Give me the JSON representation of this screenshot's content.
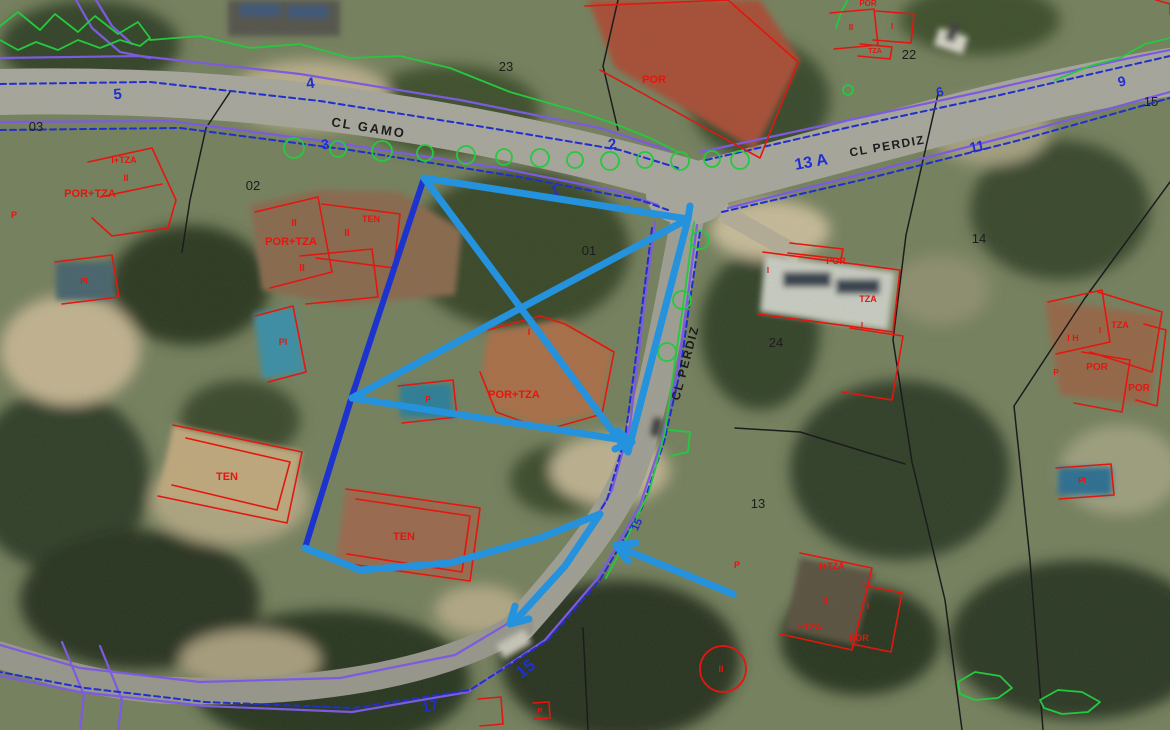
{
  "map": {
    "colors": {
      "building_red": "#E3170F",
      "boundary_purple": "#7D5BE0",
      "frontage_blue": "#1F2FD0",
      "house_number_blue": "#1F2FD0",
      "parcel_black": "#1C1C1C",
      "vegetation_green": "#25C93F",
      "annotation_main": "#2492DC",
      "annotation_dark": "#1C33CF"
    },
    "streets": [
      {
        "name": "CL GAMO",
        "x": 368,
        "y": 132,
        "rotate": 9,
        "size": 13,
        "spacing": 2
      },
      {
        "name": "CL PERDIZ",
        "x": 888,
        "y": 150,
        "rotate": -10,
        "size": 12,
        "spacing": 1.5
      },
      {
        "name": "CL PERDIZ",
        "x": 689,
        "y": 364,
        "rotate": -75,
        "size": 12,
        "spacing": 1.5
      }
    ],
    "house_numbers": [
      {
        "text": "5",
        "x": 118,
        "y": 99,
        "rotate": -5,
        "size": 15
      },
      {
        "text": "4",
        "x": 311,
        "y": 88,
        "rotate": -8,
        "size": 15
      },
      {
        "text": "3",
        "x": 326,
        "y": 149,
        "rotate": -10,
        "size": 14
      },
      {
        "text": "2",
        "x": 613,
        "y": 149,
        "rotate": -8,
        "size": 15
      },
      {
        "text": "1",
        "x": 556,
        "y": 195,
        "rotate": -15,
        "size": 14
      },
      {
        "text": "13 A",
        "x": 812,
        "y": 167,
        "rotate": -10,
        "size": 16
      },
      {
        "text": "11",
        "x": 978,
        "y": 151,
        "rotate": -12,
        "size": 14
      },
      {
        "text": "6",
        "x": 941,
        "y": 96,
        "rotate": -15,
        "size": 13
      },
      {
        "text": "9",
        "x": 1123,
        "y": 86,
        "rotate": -15,
        "size": 14
      },
      {
        "text": "15",
        "x": 640,
        "y": 526,
        "rotate": -65,
        "size": 11
      },
      {
        "text": "15",
        "x": 529,
        "y": 673,
        "rotate": -38,
        "size": 17
      },
      {
        "text": "17",
        "x": 431,
        "y": 711,
        "rotate": -12,
        "size": 15
      }
    ],
    "parcel_numbers": [
      {
        "text": "03",
        "x": 36,
        "y": 131
      },
      {
        "text": "02",
        "x": 253,
        "y": 190
      },
      {
        "text": "23",
        "x": 506,
        "y": 71
      },
      {
        "text": "01",
        "x": 589,
        "y": 255
      },
      {
        "text": "22",
        "x": 909,
        "y": 59
      },
      {
        "text": "15",
        "x": 1151,
        "y": 106
      },
      {
        "text": "14",
        "x": 979,
        "y": 243
      },
      {
        "text": "24",
        "x": 776,
        "y": 347
      },
      {
        "text": "13",
        "x": 758,
        "y": 508
      }
    ],
    "buildings": {
      "outlines": [
        {
          "points": "88,162 152,148 176,200 168,228 112,236 92,218"
        },
        {
          "points": "100,197 162,184"
        },
        {
          "points": "55,262 112,255 119,297 62,304"
        },
        {
          "points": "255,212 318,197 332,272 270,288"
        },
        {
          "points": "322,204 400,214 394,268 316,258"
        },
        {
          "points": "300,256 372,249 378,297 306,304"
        },
        {
          "points": "255,316 293,306 306,372 268,382"
        },
        {
          "points": "488,330 540,316 565,324 614,352 602,414 546,430 496,412 480,372"
        },
        {
          "points": "398,386 453,380 457,417 402,423"
        },
        {
          "points": "173,425 302,452 287,523 158,496"
        },
        {
          "points": "186,438 290,462 277,510 172,485"
        },
        {
          "points": "346,489 480,508 470,581 336,562"
        },
        {
          "points": "356,499 470,516 462,572 347,554"
        },
        {
          "points": "763,252 900,270 893,332 758,314"
        },
        {
          "points": "850,328 903,336 892,400 842,392"
        },
        {
          "points": "790,243 843,249 841,259 788,253"
        },
        {
          "points": "1048,302 1102,290 1110,342 1056,354"
        },
        {
          "points": "1098,292 1162,312 1152,372 1090,352"
        },
        {
          "points": "1082,352 1130,360 1122,412 1074,403"
        },
        {
          "points": "1144,324 1166,330 1157,406 1136,400"
        },
        {
          "points": "800,553 872,568 852,650 780,634"
        },
        {
          "points": "862,585 902,593 891,652 852,644"
        },
        {
          "points": "1056,468 1111,464 1114,495 1059,499"
        },
        {
          "points": "585,6 728,0 798,62 760,158 600,70"
        },
        {
          "points": "830,13 874,9 878,45 834,49"
        },
        {
          "points": "876,11 914,14 911,43 873,40"
        },
        {
          "points": "860,44 892,47 890,59 858,56"
        },
        {
          "points": "1156,0 1170,4 1170,14"
        },
        {
          "points": "478,699 501,697 503,724 480,726"
        },
        {
          "points": "533,703 549,702 550,718 534,719"
        }
      ],
      "circles": [
        {
          "cx": 723,
          "cy": 669,
          "r": 23
        }
      ],
      "labels": [
        {
          "text": "I+TZA",
          "x": 124,
          "y": 163,
          "size": 9
        },
        {
          "text": "II",
          "x": 126,
          "y": 181,
          "size": 9
        },
        {
          "text": "POR+TZA",
          "x": 90,
          "y": 197,
          "size": 11
        },
        {
          "text": "PI",
          "x": 84,
          "y": 284,
          "size": 8
        },
        {
          "text": "P",
          "x": 14,
          "y": 218,
          "size": 9
        },
        {
          "text": "II",
          "x": 294,
          "y": 226,
          "size": 10
        },
        {
          "text": "TEN",
          "x": 371,
          "y": 222,
          "size": 9
        },
        {
          "text": "POR+TZA",
          "x": 291,
          "y": 245,
          "size": 11
        },
        {
          "text": "II",
          "x": 302,
          "y": 271,
          "size": 10
        },
        {
          "text": "II",
          "x": 347,
          "y": 236,
          "size": 10
        },
        {
          "text": "PI",
          "x": 283,
          "y": 345,
          "size": 9
        },
        {
          "text": "I",
          "x": 529,
          "y": 335,
          "size": 9
        },
        {
          "text": "POR+TZA",
          "x": 514,
          "y": 398,
          "size": 11
        },
        {
          "text": "P",
          "x": 428,
          "y": 402,
          "size": 8
        },
        {
          "text": "TEN",
          "x": 227,
          "y": 480,
          "size": 11
        },
        {
          "text": "TEN",
          "x": 404,
          "y": 540,
          "size": 11
        },
        {
          "text": "POR",
          "x": 836,
          "y": 264,
          "size": 9
        },
        {
          "text": "I",
          "x": 768,
          "y": 273,
          "size": 8
        },
        {
          "text": "TZA",
          "x": 868,
          "y": 302,
          "size": 9
        },
        {
          "text": "I",
          "x": 862,
          "y": 328,
          "size": 8
        },
        {
          "text": "TZA",
          "x": 1120,
          "y": 328,
          "size": 9
        },
        {
          "text": "I H",
          "x": 1073,
          "y": 341,
          "size": 9
        },
        {
          "text": "I",
          "x": 1100,
          "y": 333,
          "size": 8
        },
        {
          "text": "POR",
          "x": 1097,
          "y": 370,
          "size": 10
        },
        {
          "text": "POR",
          "x": 1139,
          "y": 391,
          "size": 10
        },
        {
          "text": "P",
          "x": 1056,
          "y": 375,
          "size": 8
        },
        {
          "text": "I+TZA",
          "x": 832,
          "y": 569,
          "size": 9
        },
        {
          "text": "II",
          "x": 825,
          "y": 604,
          "size": 10
        },
        {
          "text": "I+TZA",
          "x": 809,
          "y": 630,
          "size": 9
        },
        {
          "text": "POR",
          "x": 859,
          "y": 641,
          "size": 9
        },
        {
          "text": "I",
          "x": 868,
          "y": 609,
          "size": 8
        },
        {
          "text": "P",
          "x": 737,
          "y": 568,
          "size": 9
        },
        {
          "text": "II",
          "x": 721,
          "y": 672,
          "size": 9
        },
        {
          "text": "PI",
          "x": 1082,
          "y": 483,
          "size": 8
        },
        {
          "text": "POR",
          "x": 654,
          "y": 83,
          "size": 11
        },
        {
          "text": "II",
          "x": 851,
          "y": 30,
          "size": 8
        },
        {
          "text": "I",
          "x": 892,
          "y": 29,
          "size": 8
        },
        {
          "text": "TZA",
          "x": 875,
          "y": 53,
          "size": 7
        },
        {
          "text": "POR",
          "x": 868,
          "y": 6,
          "size": 8
        },
        {
          "text": "P",
          "x": 540,
          "y": 713,
          "size": 7
        }
      ]
    },
    "boundaries": {
      "purple": [
        {
          "points": "0,58 140,56 300,74 460,100 600,128 668,150"
        },
        {
          "points": "0,122 170,121 330,142 500,168 620,192 658,205"
        },
        {
          "points": "700,152 840,122 980,92 1120,60 1170,50"
        },
        {
          "points": "728,208 870,172 1010,136 1170,92"
        },
        {
          "points": "655,222 646,290 638,360 630,425 612,490 575,555 522,615 455,655 340,678 200,682 80,668 0,645"
        },
        {
          "points": "697,225 688,295 678,368 662,440 640,505 598,578 545,640 468,692 352,712 205,706 80,692 0,676"
        },
        {
          "points": "62,642 84,695 80,730"
        },
        {
          "points": "100,646 122,700 118,730"
        },
        {
          "points": "76,0 92,28 120,52 150,58"
        },
        {
          "points": "96,0 112,26 132,44"
        }
      ],
      "blue_dashed": [
        {
          "points": "0,84 150,82 320,101 490,128 620,150 678,168"
        },
        {
          "points": "0,130 180,128 350,150 520,177 640,200 668,210"
        },
        {
          "points": "706,160 850,127 1000,95 1170,56"
        },
        {
          "points": "722,212 870,178 1020,140 1170,98"
        },
        {
          "points": "652,228 643,300 634,372 625,438 607,500 567,562 516,618"
        },
        {
          "points": "700,232 690,300 680,372 664,442 642,508 600,580 548,640 470,690 355,708 205,702 85,688 0,672"
        }
      ],
      "black": [
        {
          "points": "230,92 206,128 190,200 182,252"
        },
        {
          "points": "618,0 603,66 618,130"
        },
        {
          "points": "938,94 906,235 893,340 912,462 945,600 962,730"
        },
        {
          "points": "1170,182 1085,298 1014,406 1030,560 1043,730"
        },
        {
          "points": "583,628 588,730"
        },
        {
          "points": "735,428 800,432 905,464"
        }
      ]
    },
    "vegetation": {
      "lines": [
        {
          "points": "0,26 18,12 40,30 55,14 78,32 95,16 118,34 138,22 150,38 140,46 120,40 100,48 78,40 58,50 36,42 18,50 0,40"
        },
        {
          "points": "150,40 200,36 250,48 300,44 350,58 400,56 450,68 480,80 510,92 545,102 580,112 615,124 650,138 678,152"
        },
        {
          "points": "1055,80 1090,66 1120,58 1145,44 1170,38"
        },
        {
          "points": "836,28 842,10 848,0"
        },
        {
          "points": "668,430 690,432 688,452 670,456"
        },
        {
          "points": "694,222 685,292 675,362 665,432 649,492 620,552 606,578"
        },
        {
          "points": "958,682 975,672 1000,676 1012,688 998,698 975,700 960,694 958,682"
        },
        {
          "points": "1040,700 1058,690 1082,692 1100,702 1088,712 1062,714 1044,708 1040,700"
        }
      ],
      "trees": [
        {
          "cx": 294,
          "cy": 148,
          "r": 10
        },
        {
          "cx": 338,
          "cy": 149,
          "r": 8
        },
        {
          "cx": 382,
          "cy": 151,
          "r": 10
        },
        {
          "cx": 425,
          "cy": 153,
          "r": 8
        },
        {
          "cx": 466,
          "cy": 155,
          "r": 9
        },
        {
          "cx": 504,
          "cy": 157,
          "r": 8
        },
        {
          "cx": 540,
          "cy": 158,
          "r": 9
        },
        {
          "cx": 575,
          "cy": 160,
          "r": 8
        },
        {
          "cx": 610,
          "cy": 161,
          "r": 9
        },
        {
          "cx": 645,
          "cy": 160,
          "r": 8
        },
        {
          "cx": 680,
          "cy": 161,
          "r": 9
        },
        {
          "cx": 712,
          "cy": 159,
          "r": 8
        },
        {
          "cx": 740,
          "cy": 160,
          "r": 9
        },
        {
          "cx": 700,
          "cy": 240,
          "r": 9
        },
        {
          "cx": 682,
          "cy": 300,
          "r": 9
        },
        {
          "cx": 667,
          "cy": 352,
          "r": 9
        },
        {
          "cx": 848,
          "cy": 90,
          "r": 5
        }
      ]
    },
    "annotation": {
      "lines": [
        {
          "points": "424,178 352,396 305,548",
          "c": "dark",
          "w": 6
        },
        {
          "points": "424,178 688,219",
          "c": "main",
          "w": 7
        },
        {
          "points": "690,206 688,219 628,452",
          "c": "main",
          "w": 7
        },
        {
          "points": "424,178 628,452",
          "c": "main",
          "w": 7
        },
        {
          "points": "688,219 352,398",
          "c": "main",
          "w": 7
        },
        {
          "points": "352,398 630,441",
          "c": "main",
          "w": 7
        },
        {
          "points": "615,449 632,442 618,431",
          "c": "main",
          "w": 7
        },
        {
          "points": "305,548 360,570 450,563 540,538 600,514",
          "c": "main",
          "w": 7
        },
        {
          "points": "600,514 565,566 514,622",
          "c": "main",
          "w": 7
        },
        {
          "points": "515,606 510,624 529,619",
          "c": "main",
          "w": 7
        },
        {
          "points": "733,594 618,547",
          "c": "main",
          "w": 7
        },
        {
          "points": "636,543 616,545 628,561",
          "c": "main",
          "w": 7
        }
      ]
    }
  }
}
